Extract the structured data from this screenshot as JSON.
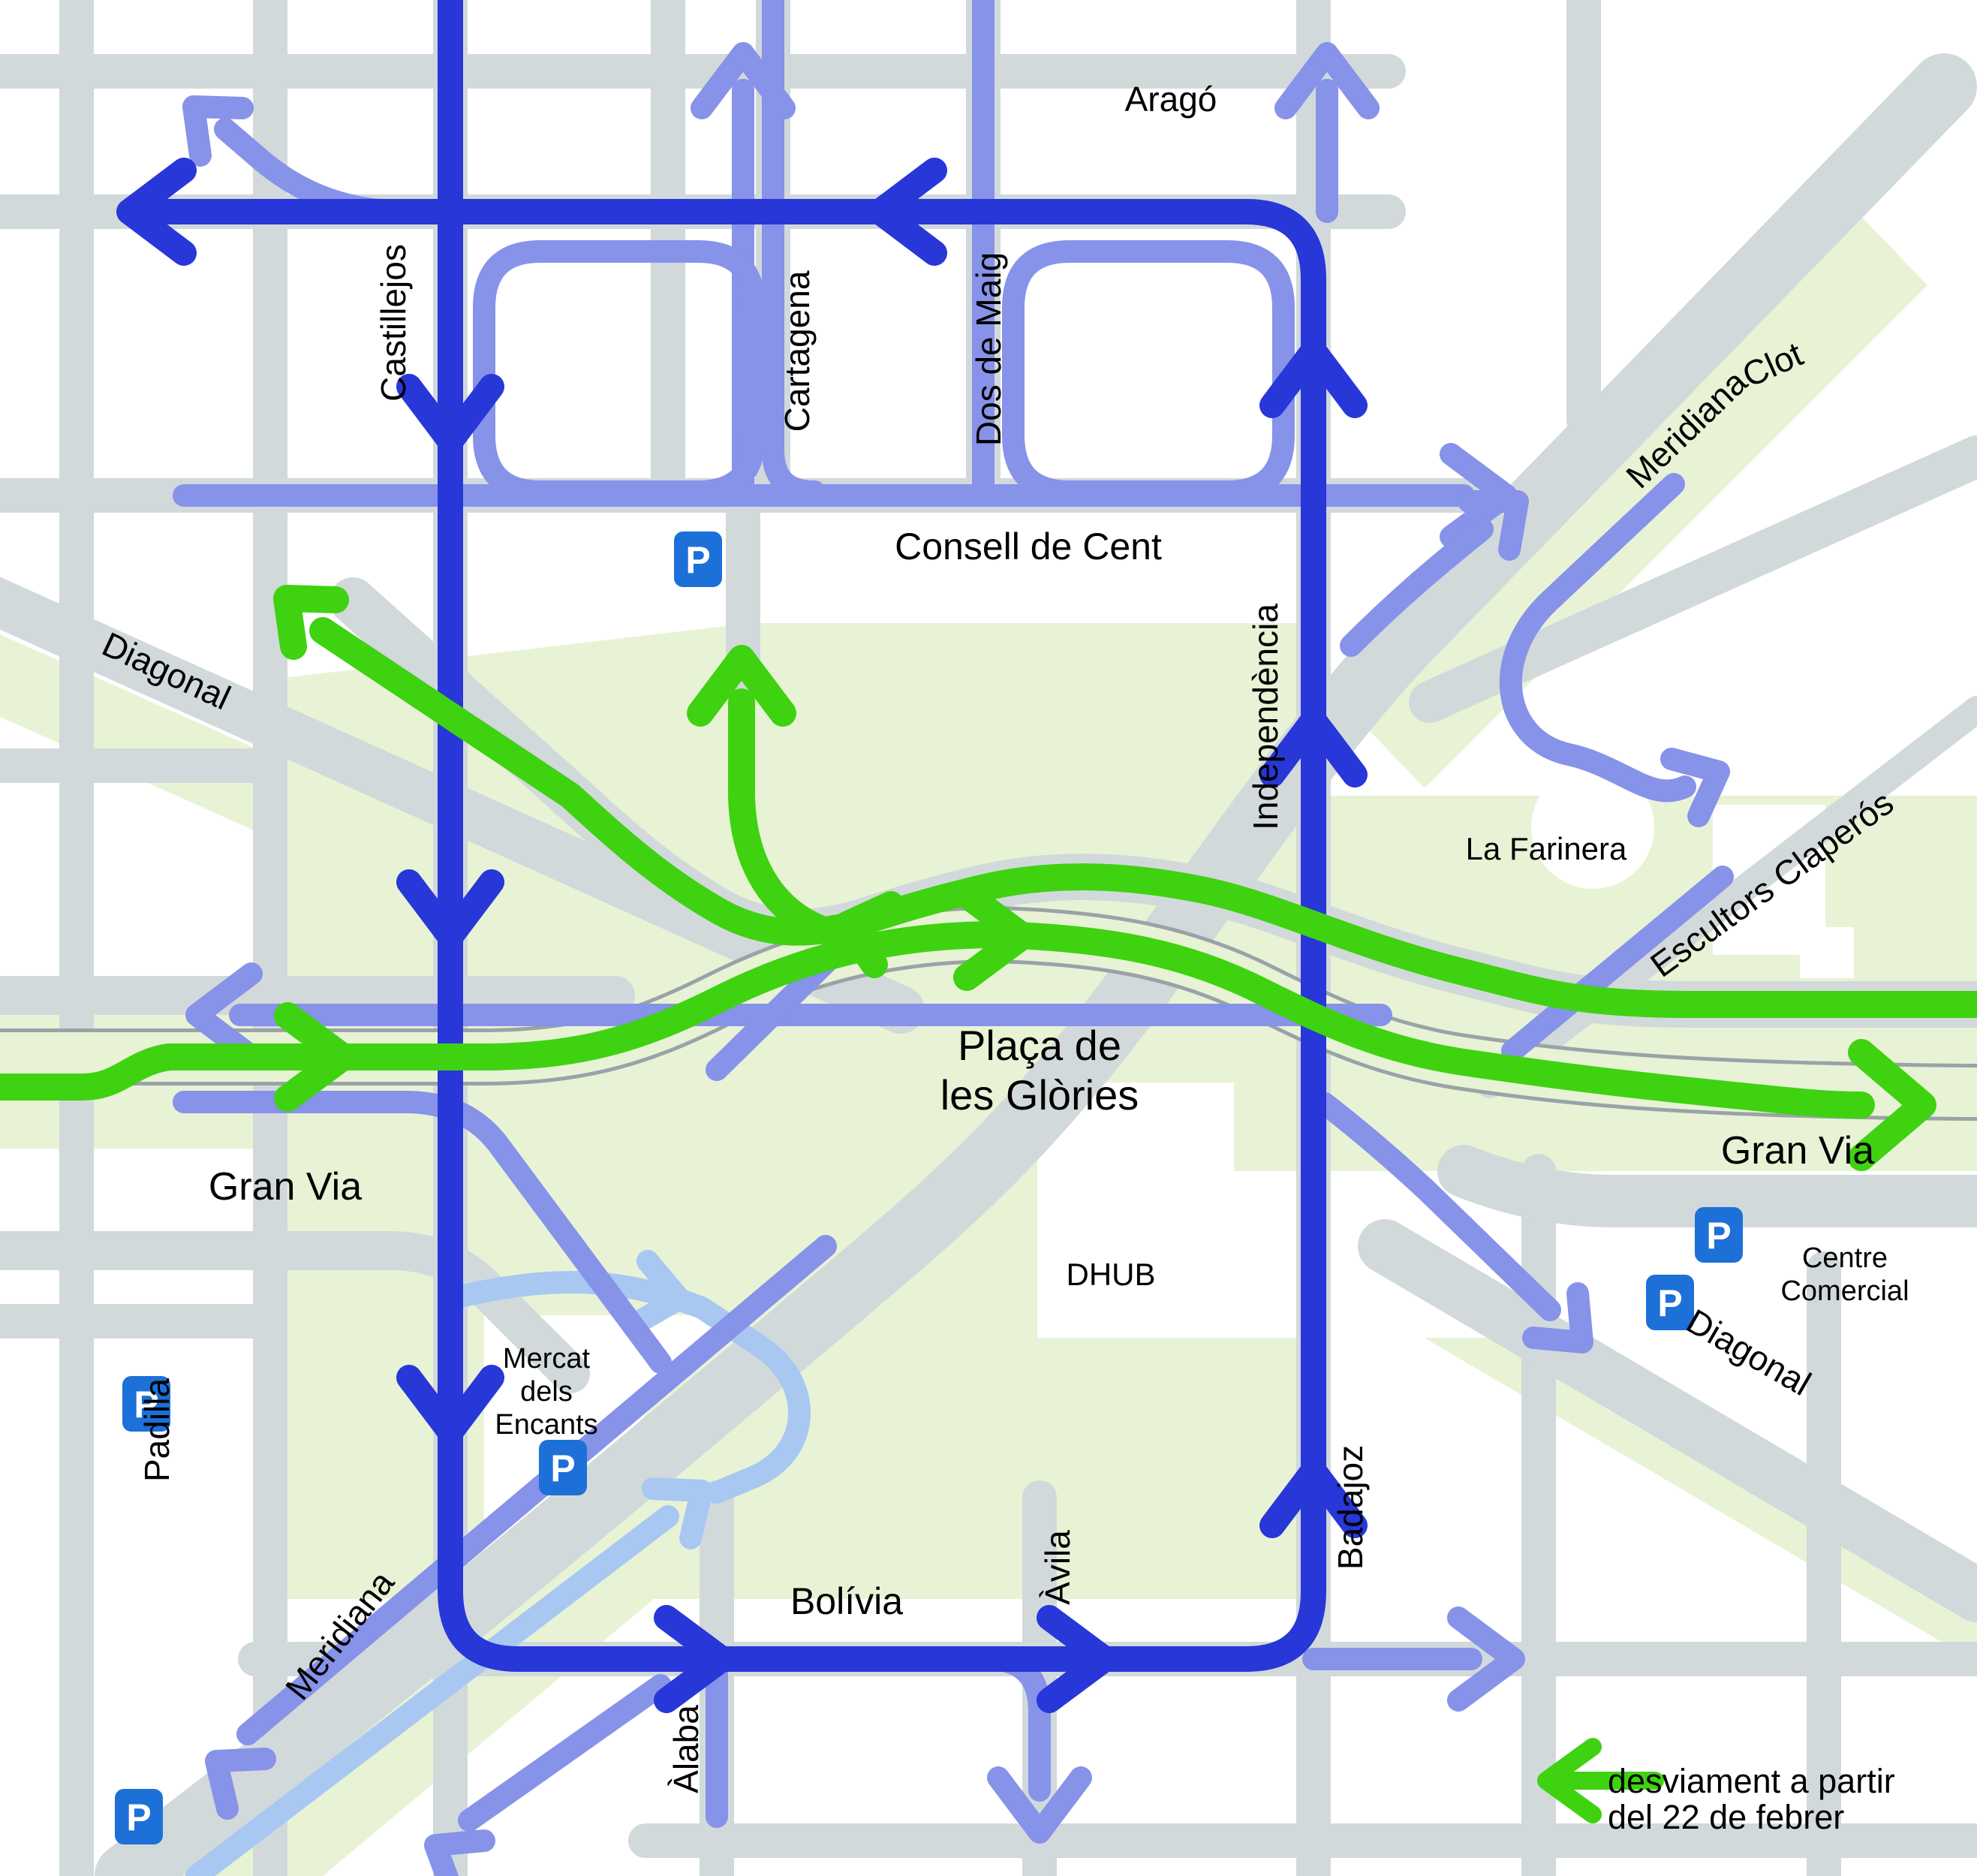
{
  "title": "Plaça de les Glòries - desviament de trànsit",
  "colors": {
    "background": "#ffffff",
    "park_green": "#e8f3d6",
    "road_gray": "#d2d9db",
    "road_edge_gray": "#99a3a7",
    "route_dark_blue": "#2737d8",
    "route_medium_blue": "#8792e9",
    "route_light_blue": "#a8c8f2",
    "route_green": "#3ed211",
    "parking_blue": "#1c70d8"
  },
  "parking_symbol": "P",
  "legend": {
    "line1": "desviament a partir",
    "line2": "del 22 de febrer"
  },
  "labels": {
    "arago": "Aragó",
    "castillejos": "Castillejos",
    "cartagena": "Cartagena",
    "dos_de_maig": "Dos de Maig",
    "consell_de_cent": "Consell de Cent",
    "meridiana_ne": "Meridiana",
    "clot": "Clot",
    "diagonal_nw": "Diagonal",
    "independencia": "Independència",
    "la_farinera": "La Farinera",
    "escultors_claperos": "Escultors Claperós",
    "placa": {
      "line1": "Plaça de",
      "line2": "les Glòries"
    },
    "gran_via_w": "Gran Via",
    "gran_via_e": "Gran Via",
    "centre_comercial": {
      "line1": "Centre",
      "line2": "Comercial"
    },
    "diagonal_se": "Diagonal",
    "mercat": {
      "line1": "Mercat",
      "line2": "dels",
      "line3": "Encants"
    },
    "dhub": "DHUB",
    "padilla": "Padilla",
    "meridiana_sw": "Meridiana",
    "avila": "Àvila",
    "alaba": "Àlaba",
    "bolivia": "Bolívia",
    "badajoz": "Badajoz"
  }
}
